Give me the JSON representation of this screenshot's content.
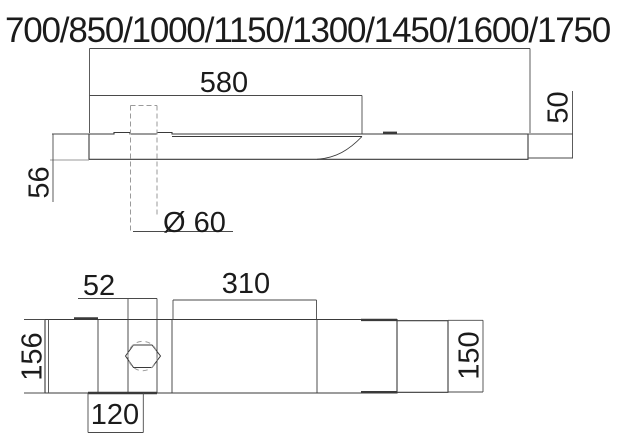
{
  "drawing": {
    "type": "technical-dimension-drawing",
    "views": [
      "side-elevation",
      "plan-underside"
    ],
    "overall_length_options_label": "700/850/1000/1150/1300/1450/1600/1750",
    "side_view": {
      "basin_length": "580",
      "right_end_height": "50",
      "left_end_height": "56",
      "hole_diameter": "Ø 60"
    },
    "plan_view": {
      "hole_span": "52",
      "ledge_length": "310",
      "left_end_width": "156",
      "right_end_width": "150",
      "hole_center_offset": "120"
    }
  },
  "colors": {
    "line": "#3a3a3a",
    "thin": "#4a4a4a",
    "hidden": "#9a9a9a",
    "text": "#1b1b1b",
    "background": "#ffffff"
  }
}
